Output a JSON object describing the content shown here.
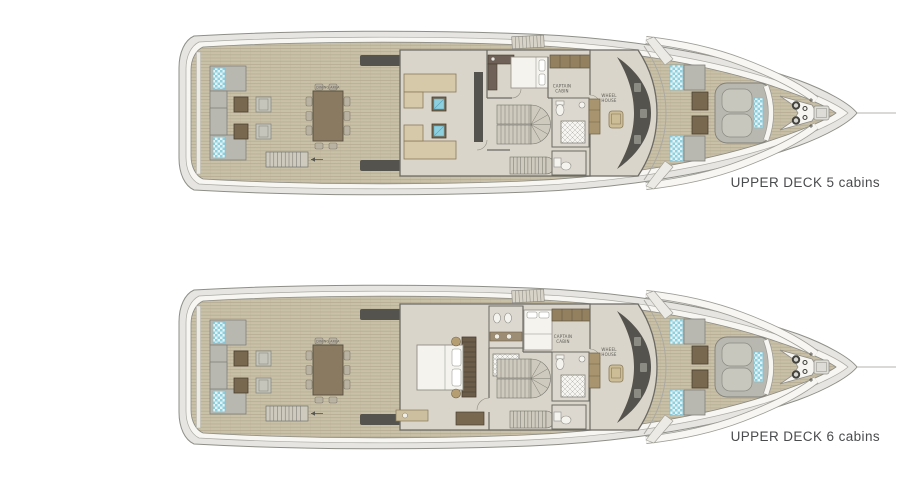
{
  "page": {
    "background": "#ffffff"
  },
  "plans": [
    {
      "id": "upper-deck-5",
      "caption": "UPPER DECK 5 cabins",
      "cabins": 5
    },
    {
      "id": "upper-deck-6",
      "caption": "UPPER DECK 6 cabins",
      "cabins": 6
    }
  ],
  "room_labels": {
    "captain_line1": "CAPTAIN",
    "captain_line2": "CABIN",
    "wheel_line1": "WHEEL",
    "wheel_line2": "HOUSE",
    "dining": "DINING AREA"
  },
  "colors": {
    "background": "#ffffff",
    "hull_band": "#e6e5e1",
    "hull_outline": "#8f8f88",
    "white_band": "#f7f6f3",
    "white_band_edge": "#aaa9a2",
    "wood": "#c9c0a8",
    "wood_line": "#b3aa91",
    "deck_edge": "#8b8b84",
    "floor": "#dad5ca",
    "wall": "#6b6a63",
    "dark_fixture": "#55534d",
    "sofa_gray": "#b9b8b0",
    "sofa_gray_stroke": "#80807a",
    "sofa_tan": "#d6c9a9",
    "sofa_tan_stroke": "#8a7a5a",
    "teal": "#8fd0df",
    "teal_bg": "#e2f2f5",
    "table_brown": "#77684f",
    "table_brown_stroke": "#4a3f30",
    "dining_table": "#8a7a62",
    "chair": "#b9b1a1",
    "chair_stroke": "#857d6d",
    "bed_white": "#f4f3ee",
    "bed_stroke": "#8f8e86",
    "cabinet_tan": "#93805f",
    "cabinet_tan_stroke": "#5e5340",
    "wardrobe_tan": "#a8956f",
    "stair_fill": "#cfcabe",
    "stair_stroke": "#73726b",
    "tile_bg": "#f6f5f1",
    "tile_line": "#b9b8b1",
    "caption_text": "#4a4b4d",
    "room_label_text": "#5a5a55"
  }
}
